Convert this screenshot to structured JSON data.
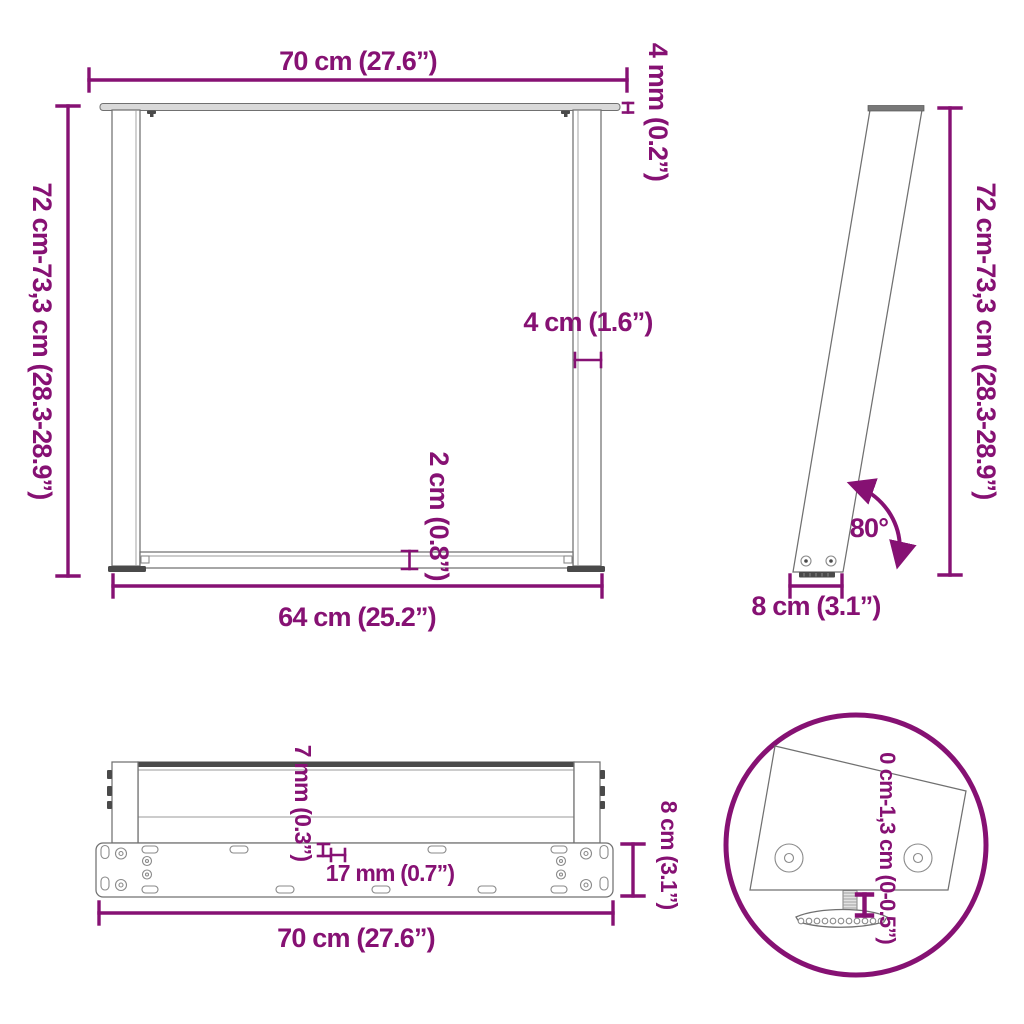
{
  "colors": {
    "accent": "#861173",
    "line": "#707070",
    "dark": "#4A4A4A",
    "light": "#D9D9D9",
    "background": "#FFFFFF"
  },
  "views": {
    "front": {
      "top_width": "70 cm (27.6”)",
      "plate_thickness": "4 mm (0.2”)",
      "height_range": "72 cm-73,3 cm (28.3-28.9”)",
      "leg_width": "4 cm (1.6”)",
      "crossbar_height": "2 cm (0.8”)",
      "bottom_width": "64 cm (25.2”)"
    },
    "side": {
      "height_range": "72 cm-73,3 cm (28.3-28.9”)",
      "angle": "80°",
      "foot_depth": "8 cm (3.1”)"
    },
    "bottom": {
      "hole_width": "7 mm (0.3”)",
      "slot_length": "17 mm (0.7”)",
      "plate_depth": "8 cm (3.1”)",
      "total_width": "70 cm (27.6”)"
    },
    "detail": {
      "adjustment_range": "0 cm-1,3 cm (0-0.5”)"
    }
  }
}
